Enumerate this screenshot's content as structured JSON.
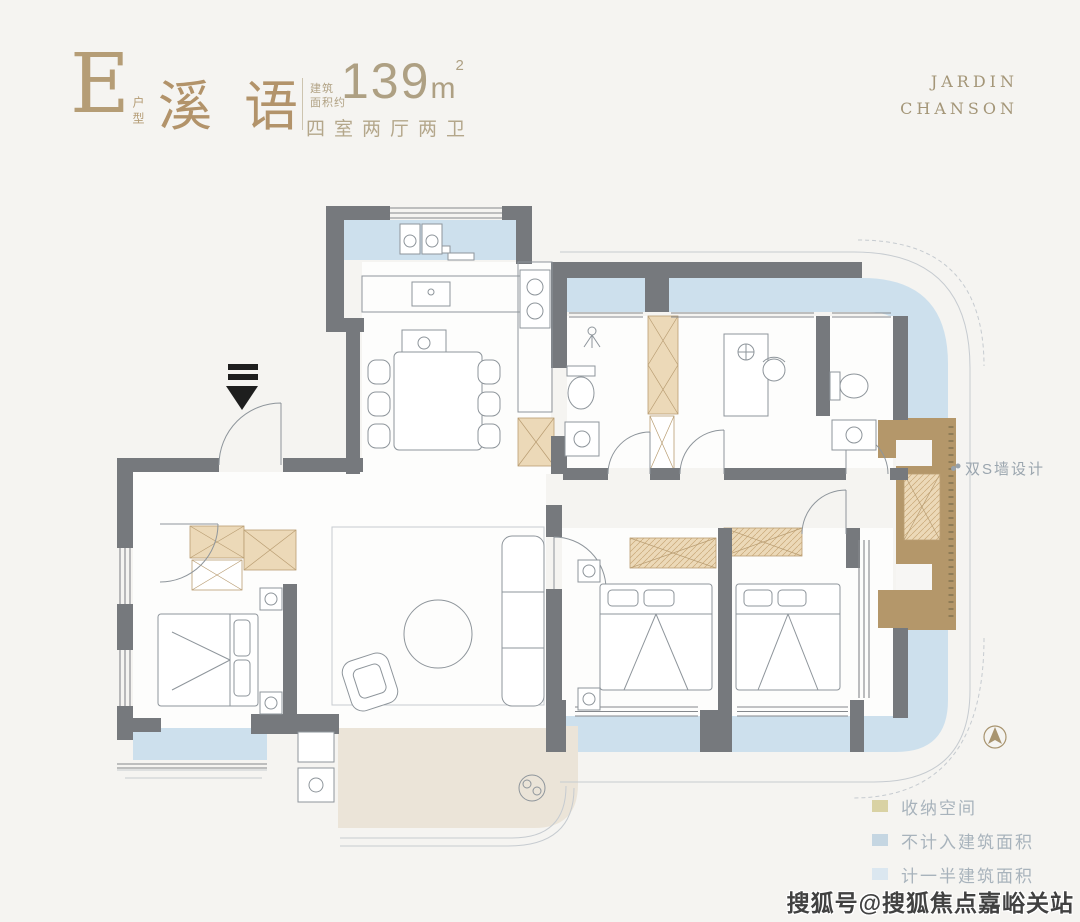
{
  "header": {
    "unit_letter": "E",
    "unit_label": "户型",
    "name": "溪语",
    "area_prefix_line1": "建筑",
    "area_prefix_line2": "面积约",
    "area_value": "139",
    "area_unit": "m",
    "area_exponent": "2",
    "layout_desc": "四室两厅两卫"
  },
  "brand": {
    "line1": "JARDIN",
    "line2": "CHANSON"
  },
  "callout": {
    "s_wall_label": "双S墙设计"
  },
  "legend": {
    "items": [
      {
        "label": "收纳空间",
        "color": "#d9d2a4"
      },
      {
        "label": "不计入建筑面积",
        "color": "#c5d6e2"
      },
      {
        "label": "计一半建筑面积",
        "color": "#dbe7f0"
      }
    ]
  },
  "watermark": {
    "text": "搜狐号@搜狐焦点嘉峪关站"
  },
  "colors": {
    "wall": "#76797d",
    "balcony": "#cde0ed",
    "terrace": "#ebe4d8",
    "storage": "#ecd9b8",
    "storage_border": "#b99d72",
    "s_wall": "#b4976a",
    "accent_gold": "#b2946a",
    "furniture_line": "#8e959b",
    "outline_thin": "#c6cbd0"
  }
}
